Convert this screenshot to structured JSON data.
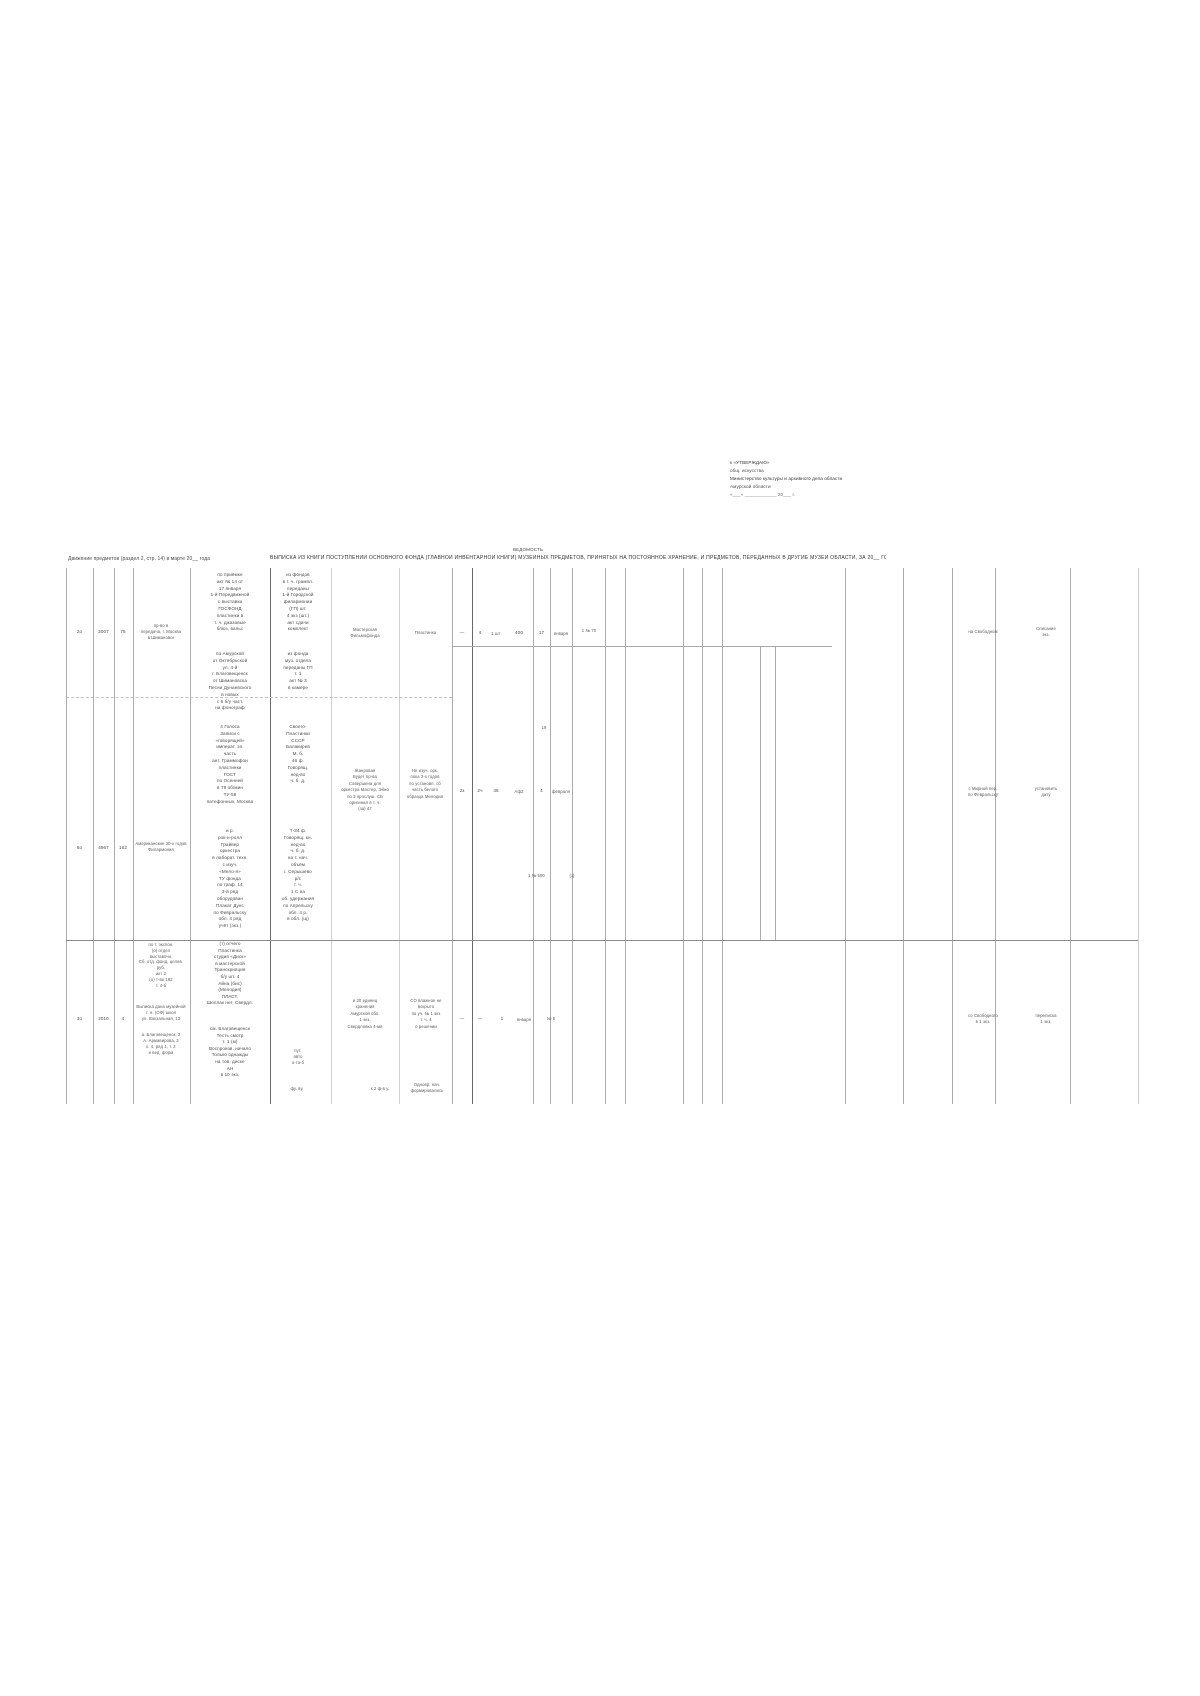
{
  "header_note": {
    "line1": "к «УТВЕРЖДАЮ»",
    "line2": "общ. искусства",
    "line3": "Министерство культуры и архивного дела области",
    "line4": "Амурской области",
    "line5": "«___» ____________ 20___ г."
  },
  "title": {
    "kicker": "ВЕДОМОСТЬ",
    "line": "ВЫПИСКА ИЗ КНИГИ ПОСТУПЛЕНИЙ ОСНОВНОГО ФОНДА (ГЛАВНОЙ ИНВЕНТАРНОЙ КНИГИ) МУЗЕЙНЫХ ПРЕДМЕТОВ, ПРИНЯТЫХ НА ПОСТОЯННОЕ ХРАНЕНИЕ, И ПРЕДМЕТОВ, ПЕРЕДАННЫХ В ДРУГИЕ МУЗЕИ ОБЛАСТИ, ЗА 20__ ГОД"
  },
  "subtitle_left": "Движение предметов (раздел 2, стр. 14) в марте 20__ года",
  "rows": [
    {
      "no": "2о",
      "date": "2007",
      "num": "75",
      "col4": "пр-во в\nпередача, г. Москва\nв Шимановск",
      "col5_top": "по приёмке\nакт № 14 от\n17 января\n1-й Передвижной\nс выставки\nГОСФОНД\nпластинки в\nт. ч. джазовые\nблюз, вальс",
      "col6_top": "из фондов\nв т. ч. грампл.\nпереданы\n1-й Городской\nфилармонии\n(ГП) шт.\n4 экз (шт.)\nакт сдачи\nкомплект",
      "col5_bottom": "по Амурской\nот Октябрьской\nул. 4-й\nг. Благовещенск\nот Шимановска\nПесни Дунаевского\nв новых\nс 6 б/у част.\nна фонограф",
      "col6_bottom": "из фонда\nмуз. отдела\nпереданы ГП\nт. 1\nакт № 3\nв камере",
      "col7": "Мастерская\nФильмофонда",
      "col8": "Пластинка",
      "c_dash": "—",
      "c_q": "4",
      "c_unit": "1 шт",
      "c_price": "400",
      "c_day": "17",
      "c_month": "января",
      "c_note": "1 № 70",
      "right1": "на Свободном",
      "right2": "Списание\nэкз."
    },
    {
      "no": "6о",
      "date": "4967",
      "num": "162",
      "col4": "Американские 30-х годов\nФилармония",
      "col5_top": "4 Голоса\nЗаписи с\n«говорящей»\nимперат. эл.\nчасть\nант. Граммофон\nпластинки\nГОСТ\nпо Осенней\nв 78 об/мин\nТУ-58\nпатефонных, Москва",
      "col6_top": "Своего-\nПластинки\nСССР\nБалакирев\nМ. б.\n46 ф.\nГоворящ.\nнед-во\nч. б. д.",
      "col5_bottom": "и р.\nрок-н-ролл\nГрайвер\nоркестра\nв лаборат. техн.\nс изуч.\n«Мело-я»\nТУ фонда\nпо граф. 14\n3-й ряд\nоборудован\nПлакат Дунс\nпо Февральску\nобл. 4 ряд\nучёт (экз.)",
      "col6_bottom": "Т-34 ф.\nГоворящ. кн.\nнед-во\nч. б. д.\nна т. нач.\nобъём\nг. Серышево\nр/с\nт. ч.\n1 С на\nоб. удержания\nпо Апрельску\nобл. 4 р.\nв обл. (щ)",
      "col7": "Жанровая\nБудет пр-ва\nСовершена для\nоркестра Мастер, Эйно\nпо 3 прослуш. СБ\nоригинал в т. ч.\n(за) 47",
      "col8": "Не изуч. орк.\nпока 2-х годов\nпо установл. сб\nчасть белого\nобразца Мелодия",
      "c1": "2з",
      "c2": "2ч",
      "c3": "46",
      "c4": "Аф2",
      "c5": "4",
      "c6": "февраля",
      "mark19": "19",
      "serial": "1 № 500",
      "serial_note": "(з)",
      "right1": "с Мирной пер.\nпо Февральску",
      "right2": "установить\nдату"
    },
    {
      "no": "3о",
      "date": "2010",
      "num": "4",
      "col4_top": "по т. экспон.\n(о) отдел\nвыставочн.\nСб. отд. фонд, целев.\nруб.\nакт 2\n(о) т-во 182\nт. 4-б",
      "col4_main": "Выписка дана музейной\nт. н. (ОФ) школ\nул. Вокзальная, 13",
      "col4_sub": "а. Благовещенск, 2\nА. Армавирова, 3\nк. 4, ряд 1, т. 2\nи вед. форм",
      "col5": "(т) отчего\nПластинка\nстудия «Диск»\nв мастерской\nТранскрипция\nб/у шт. 4\nАйна (бис)\n(Мелодия)\nПЛАСТ.\nШеллак нет, Свердл.",
      "col5_low": "см. Благовещенск\nТесть смотр\nт. 1 (м)\nВоспроизв. начало\nТолько однажды\nна тов. диске\nАН\nв 10 экз.",
      "col6_low": "пут.\nавто\nо-та-б",
      "col6_foot": "фу. ву.",
      "col7": "и 20 единиц\nхранения\nАмурской обл.\n1 экз.\nСвердловка 4-мя",
      "col7_foot": "к 2 ф-в у.",
      "col8": "СО влажное не\nвскрыто\nпо уч. № 1 экз\nт. ч. 4\nо решении",
      "col8_foot": "Одновр. нач.\nформировались",
      "cdash1": "—",
      "cdash2": "—",
      "cq": "1",
      "cmonth": "января",
      "cnum": "№ 5",
      "right1": "со Свободного\nв 1 экз.",
      "right2": "переписка\n1 экз."
    }
  ]
}
